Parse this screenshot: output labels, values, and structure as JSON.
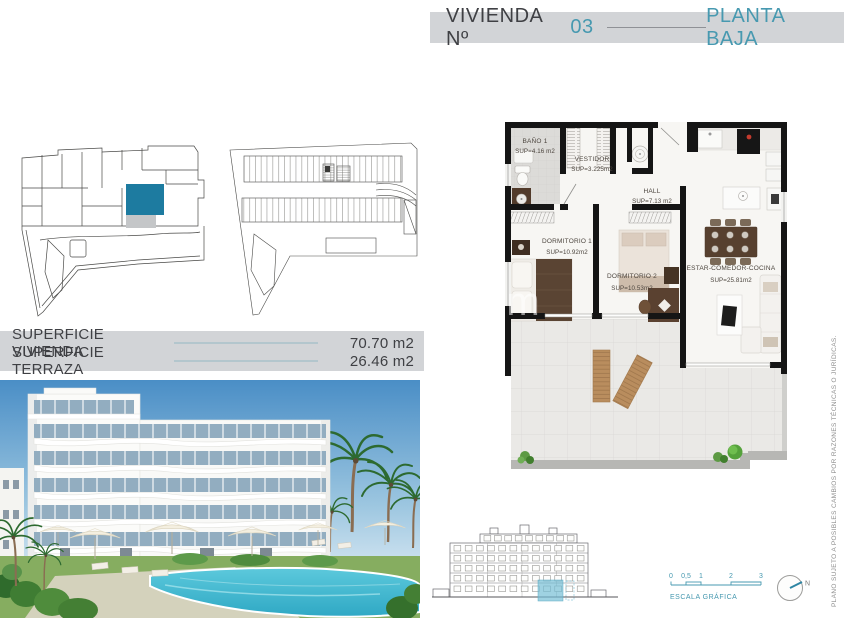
{
  "header": {
    "title_prefix": "VIVIENDA Nº",
    "unit_number": "03",
    "floor_label": "PLANTA BAJA"
  },
  "floor_plan": {
    "watermark": ".com",
    "rooms": [
      {
        "name": "BAÑO 1",
        "area": "SUP=4.16 m2"
      },
      {
        "name": "VESTIDOR",
        "area": "SUP=3.225m2"
      },
      {
        "name": "HALL",
        "area": "SUP=7.13 m2"
      },
      {
        "name": "DORMITORIO 1",
        "area": "SUP=10.92m2"
      },
      {
        "name": "DORMITORIO 2",
        "area": "SUP=10.53m2"
      },
      {
        "name": "ESTAR-COMEDOR-COCINA",
        "area": "SUP=25.81m2"
      }
    ]
  },
  "surfaces": {
    "rows": [
      {
        "label": "SUPERFICIE VIVIENDA",
        "value": "70.70 m2"
      },
      {
        "label": "SUPERFICIE TERRAZA",
        "value": "26.46 m2"
      }
    ]
  },
  "scale_bar": {
    "ticks": [
      "0",
      "0,5",
      "1",
      "2",
      "3"
    ],
    "label": "ESCALA GRÁFICA"
  },
  "compass": {
    "label": "N"
  },
  "disclaimer": "PLANO SUJETO A POSIBLES CAMBIOS POR RAZONES TÉCNICAS O JURÍDICAS.",
  "colors": {
    "accent_teal": "#4799b0",
    "unit_highlight_fill": "#1d7ba0",
    "elevation_highlight": "#72bcd4",
    "band_bg": "#d2d4d7",
    "dark_text": "#3f4044"
  }
}
